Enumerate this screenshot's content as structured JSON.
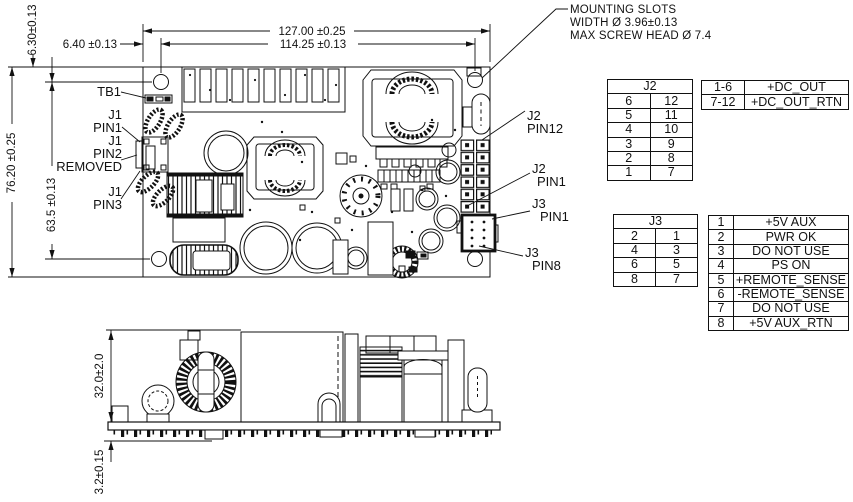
{
  "notes": {
    "mounting_slots": [
      "MOUNTING SLOTS",
      "WIDTH Ø 3.96±0.13",
      "MAX SCREW HEAD Ø 7.4"
    ]
  },
  "dimensions": {
    "board_width": "127.00 ±0.25",
    "hole_span_h": "114.25 ±0.13",
    "edge_to_hole_h": "6.40 ±0.13",
    "edge_to_hole_v": "6.30±0.13",
    "board_height": "76.20 ±0.25",
    "hole_span_v": "63.5 ±0.13",
    "component_height": "32.0±2.0",
    "pin_protrusion": "3.2±0.15"
  },
  "labels": {
    "tb1": "TB1",
    "j1_pin1": {
      "l1": "J1",
      "l2": "PIN1"
    },
    "j1_pin2": {
      "l1": "J1",
      "l2": "PIN2",
      "l3": "REMOVED"
    },
    "j1_pin3": {
      "l1": "J1",
      "l2": "PIN3"
    },
    "j2_pin12": {
      "l1": "J2",
      "l2": "PIN12"
    },
    "j2_pin1": {
      "l1": "J2",
      "l2": "PIN1"
    },
    "j3_pin1": {
      "l1": "J3",
      "l2": "PIN1"
    },
    "j3_pin8": {
      "l1": "J3",
      "l2": "PIN8"
    }
  },
  "tables": {
    "j2_pins": {
      "title": "J2",
      "rows": [
        [
          "6",
          "12"
        ],
        [
          "5",
          "11"
        ],
        [
          "4",
          "10"
        ],
        [
          "3",
          "9"
        ],
        [
          "2",
          "8"
        ],
        [
          "1",
          "7"
        ]
      ]
    },
    "j2_functions": {
      "rows": [
        [
          "1-6",
          "+DC_OUT"
        ],
        [
          "7-12",
          "+DC_OUT_RTN"
        ]
      ]
    },
    "j3_pins": {
      "title": "J3",
      "rows": [
        [
          "2",
          "1"
        ],
        [
          "4",
          "3"
        ],
        [
          "6",
          "5"
        ],
        [
          "8",
          "7"
        ]
      ]
    },
    "j3_functions": {
      "rows": [
        [
          "1",
          "+5V AUX"
        ],
        [
          "2",
          "PWR OK"
        ],
        [
          "3",
          "DO NOT USE"
        ],
        [
          "4",
          "PS ON"
        ],
        [
          "5",
          "+REMOTE_SENSE"
        ],
        [
          "6",
          "-REMOTE_SENSE"
        ],
        [
          "7",
          "DO NOT USE"
        ],
        [
          "8",
          "+5V AUX_RTN"
        ]
      ]
    }
  }
}
